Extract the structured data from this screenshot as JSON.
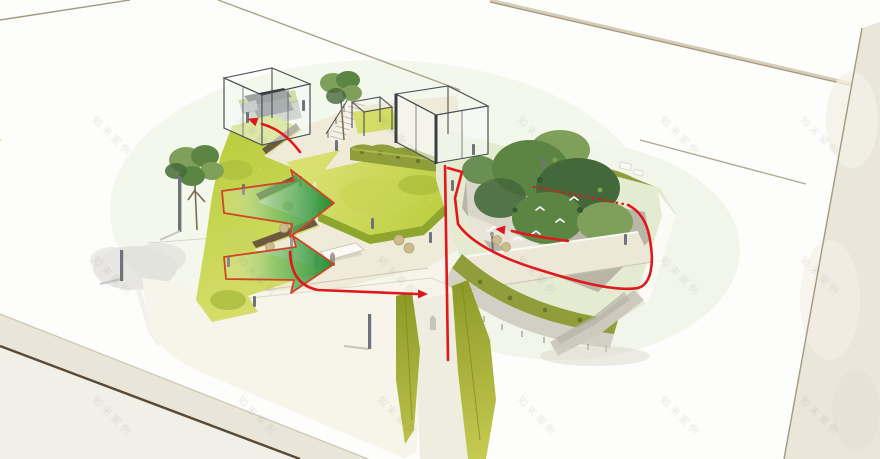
{
  "watermark": {
    "text": "知末案例",
    "rows": [
      112,
      252,
      392
    ],
    "cols": [
      100,
      245,
      385,
      525,
      668,
      808
    ]
  },
  "colors": {
    "bg": "#fdfdfb",
    "margin": "#eae6da",
    "margin_blob": "#f3f0e6",
    "line_tan": "#a6987e",
    "line_dark": "#5a4936",
    "line_light": "#d6cdb9",
    "street": "#e9e6d9",
    "outer_block": "#f1efe7",
    "apron": "#f7f4ea",
    "paving": "#f0ead9",
    "paving_grid": "#dcd3bc",
    "lawn_light": "#d9e070",
    "lawn_mid": "#b8cc3b",
    "lawn_dark": "#8ea62c",
    "ramp_light": "#c6cb52",
    "ramp_dark": "#8c9826",
    "hedge": "#8f9d3a",
    "hedge_dark": "#66762a",
    "hedge_light": "#b3bf55",
    "terrace": "#e5ebd1",
    "tree_light": "#7fa05a",
    "tree_mid": "#5c8544",
    "tree_dark": "#45683a",
    "glass_frame": "#4a4f52",
    "glass_fill": "rgba(248,251,249,0.55)",
    "stair_dark": "#33383b",
    "wall_gray": "#cdc9bd",
    "wall_shadow": "#b7b3a6",
    "pit_floor": "#b9b6a8",
    "pit_wall": "#d8d5c9",
    "red": "#e0181c",
    "arrow_outline": "#cf4526",
    "arrow_green": "#1f8c36",
    "post": "#6f737a",
    "seat": "#cdbb8e",
    "fascia": "#fbfaf5",
    "figure": "#8a877e",
    "bird": "#ffffff",
    "ghost": "#d2d1cb",
    "watermark": "rgba(120,120,110,0.14)",
    "retaining": "#6b5940",
    "speck_yellow": "#e3d957"
  },
  "scene": {
    "green_entry_arrows": 2,
    "red_route_lines": 5,
    "glass_pavilions": 2,
    "plaza_trees": 2,
    "garden_birds": 6
  }
}
